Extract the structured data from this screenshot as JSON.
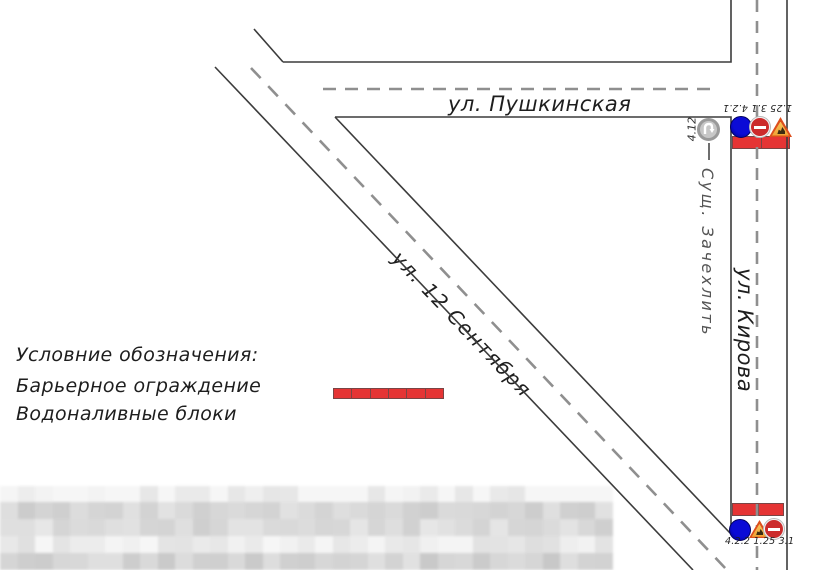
{
  "streets": {
    "pushkinskaya": {
      "label": "ул. Пушкинская"
    },
    "kirova": {
      "label": "ул. Кирова"
    },
    "sentyabrya": {
      "label": "ул. 12 Сентября"
    }
  },
  "legend": {
    "title": "Условние обозначения:",
    "items": [
      {
        "label": "Барьерное ограждение",
        "symbol": "barrier-fence"
      },
      {
        "label": "Водоналивные блоки",
        "symbol": "water-filled-blocks"
      }
    ]
  },
  "signs": {
    "north_group": {
      "codes_label": "1.25 3.1 4.2.1",
      "icons": [
        "detour-right-sign",
        "no-entry-sign",
        "road-works-sign"
      ]
    },
    "south_group": {
      "codes_label": "4.2.2 1.25 3.1",
      "icons": [
        "detour-left-sign",
        "road-works-sign",
        "no-entry-sign"
      ]
    },
    "existing_sign": {
      "code": "4.12",
      "note": "Сущ. Зачехлить"
    }
  },
  "colors": {
    "sign_blue": "#0b0bd6",
    "sign_red": "#cc2b2b",
    "barrier_red": "#e53434",
    "barrier_border": "#7a4444",
    "warning_orange": "#efa233",
    "warning_border": "#dd4f1d",
    "road_line": "#3c3c3c",
    "dash_gray": "#8f8f8f"
  }
}
